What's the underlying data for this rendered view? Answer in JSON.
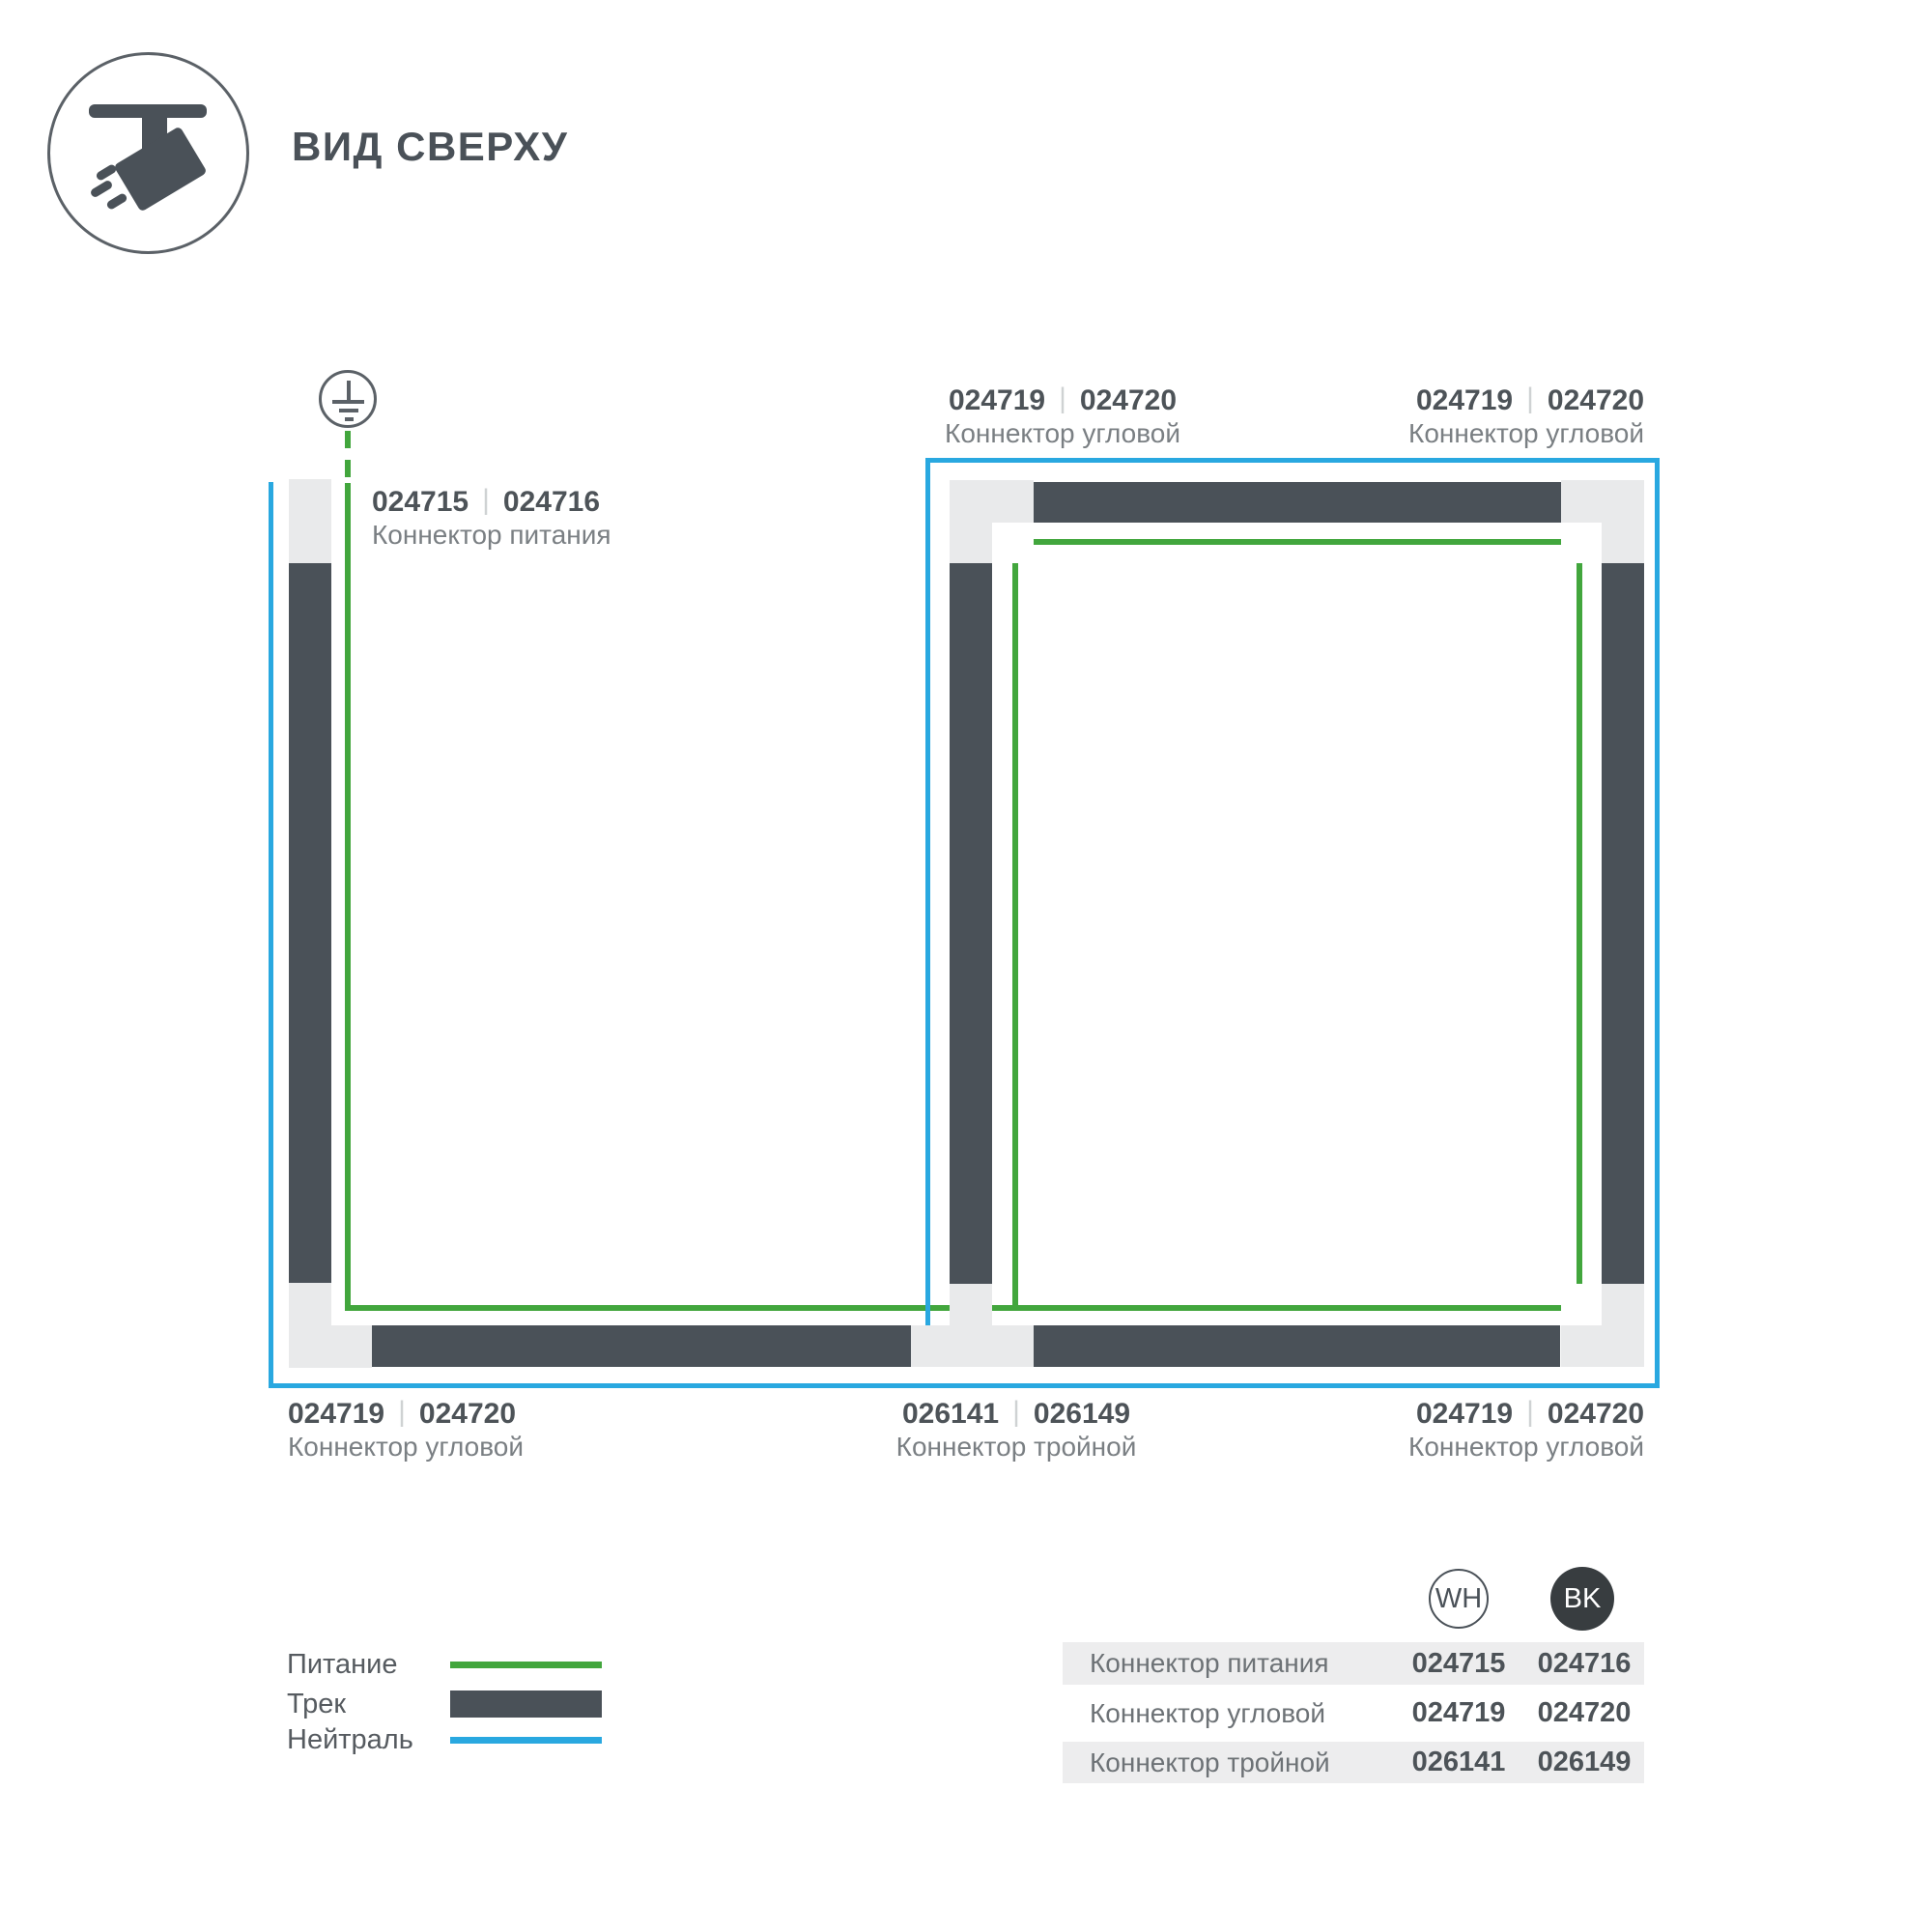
{
  "page": {
    "title": "ВИД СВЕРХУ"
  },
  "ui": {
    "code_separator": "|"
  },
  "colors": {
    "track": "#4a5158",
    "connector_piece": "#e9eaeb",
    "power_line_green": "#42a63d",
    "neutral_line_blue": "#29a8e0",
    "table_band": "#ededee",
    "bk_badge": "#383d40"
  },
  "diagram_labels": {
    "power_feed": {
      "code_wh": "024715",
      "code_bk": "024716",
      "label": "Коннектор питания"
    },
    "corner_top_middle": {
      "code_wh": "024719",
      "code_bk": "024720",
      "label": "Коннектор угловой"
    },
    "corner_top_right": {
      "code_wh": "024719",
      "code_bk": "024720",
      "label": "Коннектор угловой"
    },
    "corner_bottom_left": {
      "code_wh": "024719",
      "code_bk": "024720",
      "label": "Коннектор угловой"
    },
    "triple_bottom_middle": {
      "code_wh": "026141",
      "code_bk": "026149",
      "label": "Коннектор тройной"
    },
    "corner_bottom_right": {
      "code_wh": "024719",
      "code_bk": "024720",
      "label": "Коннектор угловой"
    }
  },
  "legend": {
    "power": "Питание",
    "track": "Трек",
    "neutral": "Нейтраль"
  },
  "table": {
    "columns": {
      "wh": "WH",
      "bk": "BK"
    },
    "rows": [
      {
        "label": "Коннектор питания",
        "wh": "024715",
        "bk": "024716"
      },
      {
        "label": "Коннектор угловой",
        "wh": "024719",
        "bk": "024720"
      },
      {
        "label": "Коннектор тройной",
        "wh": "026141",
        "bk": "026149"
      }
    ]
  }
}
